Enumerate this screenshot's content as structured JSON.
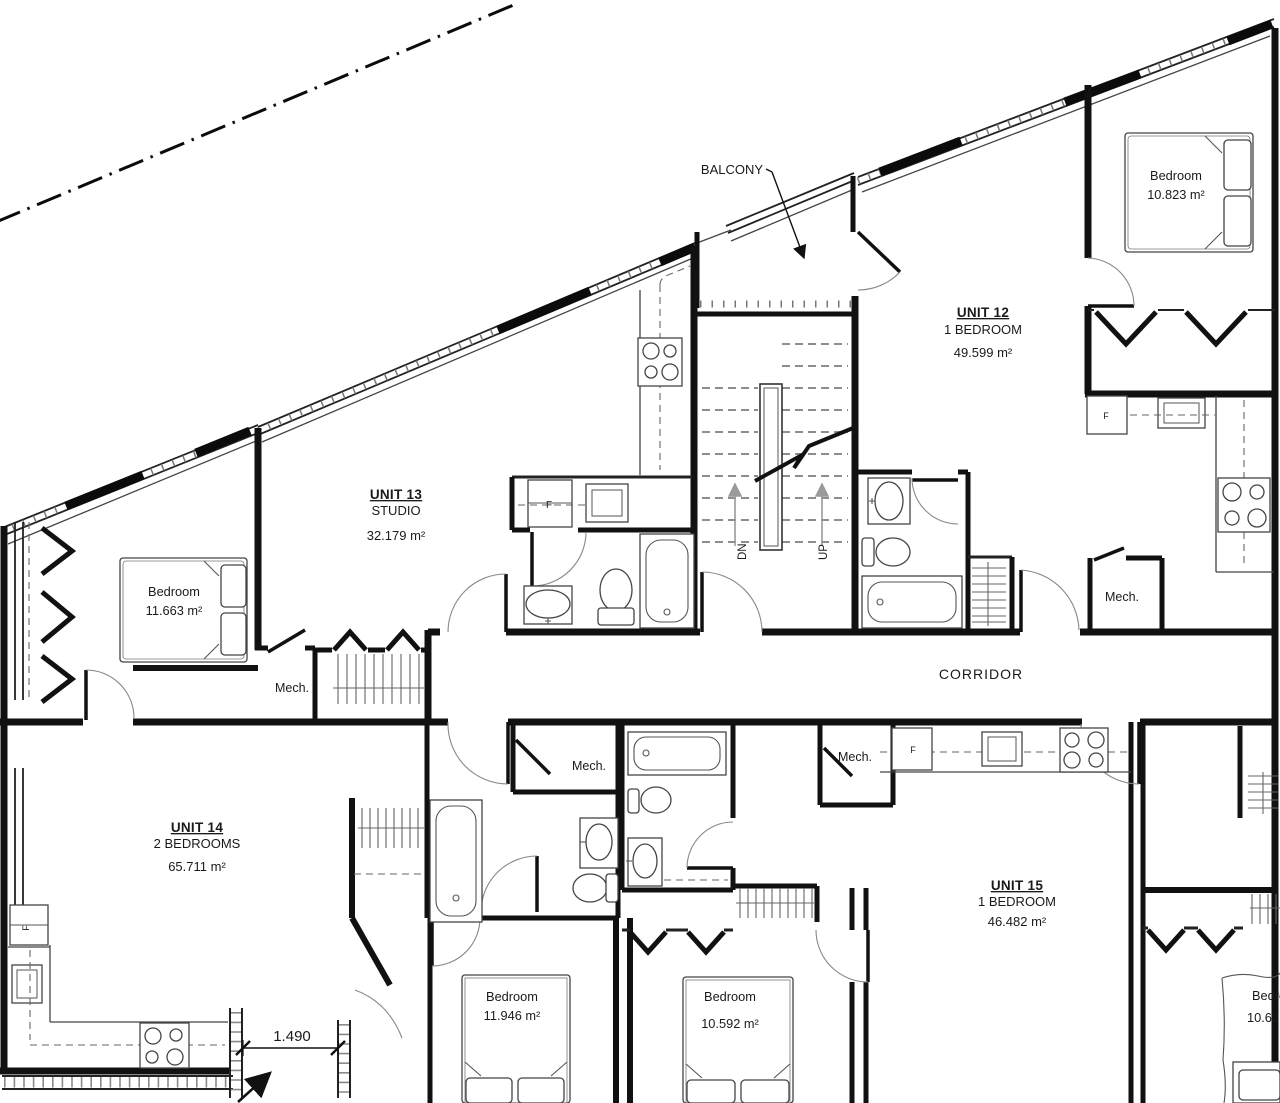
{
  "drawing": {
    "units": [
      {
        "name": "UNIT 12",
        "type": "1 BEDROOM",
        "area": "49.599 m²"
      },
      {
        "name": "UNIT 13",
        "type": "STUDIO",
        "area": "32.179 m²"
      },
      {
        "name": "UNIT 14",
        "type": "2 BEDROOMS",
        "area": "65.711 m²"
      },
      {
        "name": "UNIT 15",
        "type": "1 BEDROOM",
        "area": "46.482 m²"
      }
    ],
    "bedrooms": [
      {
        "name": "Bedroom",
        "area": "10.823 m²"
      },
      {
        "name": "Bedroom",
        "area": "11.663 m²"
      },
      {
        "name": "Bedroom",
        "area": "11.946 m²"
      },
      {
        "name": "Bedroom",
        "area": "10.592 m²"
      },
      {
        "name": "Bedroom",
        "area": "10.62"
      }
    ],
    "labels": {
      "balcony": "BALCONY",
      "corridor": "CORRIDOR",
      "mech": "Mech.",
      "down": "DN",
      "up": "UP",
      "fridge": "F",
      "dimension": "1.490"
    }
  }
}
